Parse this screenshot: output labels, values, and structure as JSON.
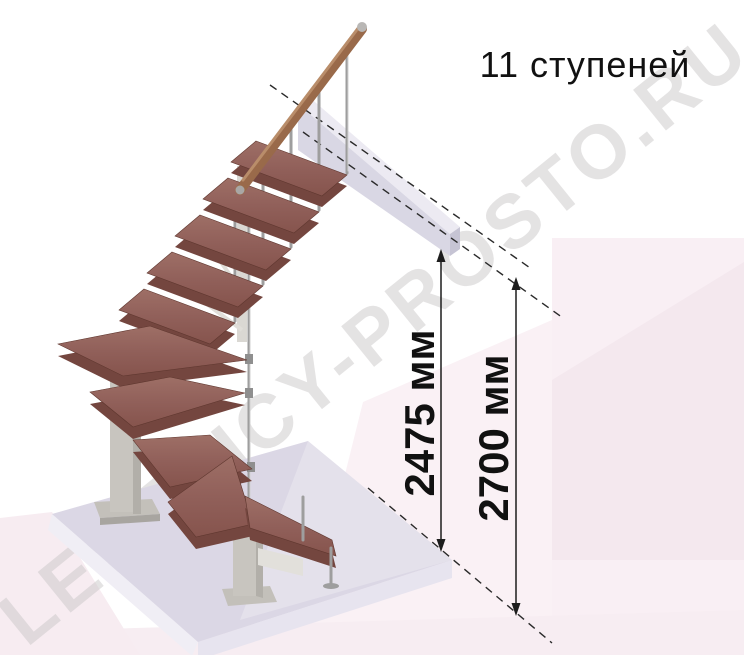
{
  "title": "11 ступеней",
  "watermark": "LESTNICY-PROSTO.RU",
  "dimensions": {
    "ceiling_height": {
      "label": "2475 мм"
    },
    "floor_to_floor": {
      "label": "2700 мм"
    }
  },
  "illustration": {
    "description": "isometric modular staircase with 11 steps, winder turn, central stringer, wooden handrail",
    "colors": {
      "tread_top": "#956057",
      "tread_edge": "#74463f",
      "handrail": "#9b6a4c",
      "baluster": "#9e9e9e",
      "steel_column": "#c8c5bf",
      "floor_slab": "#dbd7e5",
      "upper_beam": "#d9d7e4",
      "background_pink": "#f8eef3",
      "dimension_text": "#111111",
      "watermark_gray": "#cbc8c9"
    }
  }
}
